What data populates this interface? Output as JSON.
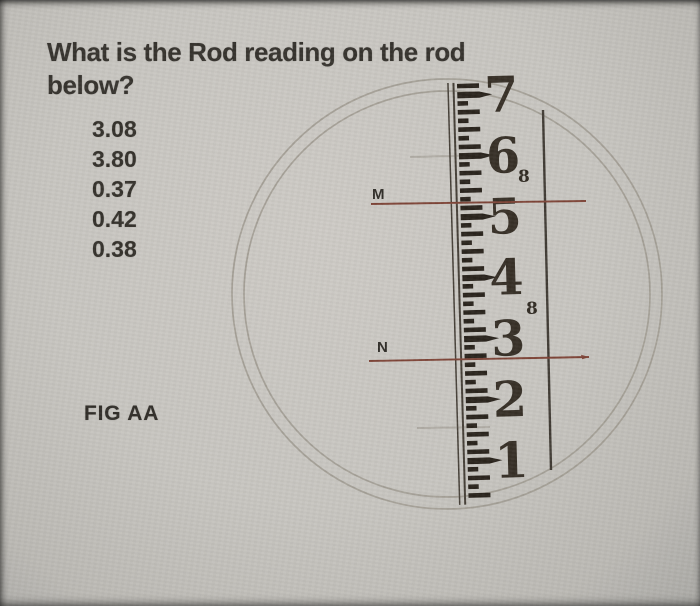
{
  "question": {
    "line1": "What is the Rod reading on the rod",
    "line2": "below?"
  },
  "options": [
    "3.08",
    "3.80",
    "0.37",
    "0.42",
    "0.38"
  ],
  "fig_label": "FIG AA",
  "crosshairs": {
    "upper": {
      "label": "M"
    },
    "lower": {
      "label": "N"
    }
  },
  "colors": {
    "paper": "#c8c6c1",
    "ink": "#33302a",
    "rod_ink": "#28221b",
    "crosshair": "#7d4336",
    "pencil": "#9b968c",
    "edge_line": "#443e36"
  },
  "figure": {
    "circle": {
      "cx": 447,
      "cy": 294,
      "radii": [
        215,
        203
      ]
    },
    "pencil_lines": [
      {
        "x1": 410,
        "y1": 157,
        "x2": 492,
        "y2": 155
      },
      {
        "x1": 417,
        "y1": 428,
        "x2": 490,
        "y2": 427
      }
    ],
    "rod": {
      "x": 448,
      "top": 85,
      "bottom": 503,
      "tilt": -1.6,
      "unit": 61,
      "tick_min": -2,
      "tick_max": 418,
      "numbers": [
        {
          "label": "7",
          "y": 95
        },
        {
          "label": "6",
          "y": 156
        },
        {
          "label": "5",
          "y": 217
        },
        {
          "label": "4",
          "y": 278
        },
        {
          "label": "3",
          "y": 339
        },
        {
          "label": "2",
          "y": 400
        },
        {
          "label": "1",
          "y": 461
        }
      ],
      "subscripts": [
        {
          "label": "8",
          "x": 518,
          "y": 182
        },
        {
          "label": "8",
          "x": 526,
          "y": 314
        }
      ]
    },
    "right_line": {
      "x1": 543,
      "y1": 110,
      "x2": 551,
      "y2": 470
    },
    "crosshair_lines": {
      "upper": {
        "x1": 371,
        "y1": 204,
        "x2": 586,
        "y2": 201,
        "arrow": false
      },
      "lower": {
        "x1": 369,
        "y1": 361,
        "x2": 589,
        "y2": 357,
        "arrow": true
      }
    }
  }
}
